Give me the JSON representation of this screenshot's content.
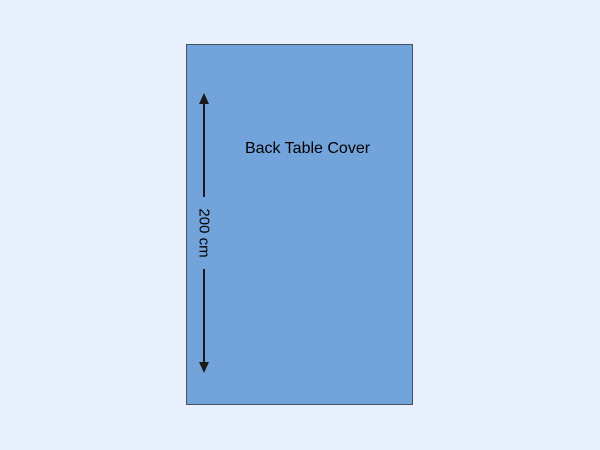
{
  "diagram": {
    "title": "Back Table Cover",
    "dimension_label": "200 cm"
  },
  "colors": {
    "page_background": "#e8effd",
    "cover_fill": "#72a3da",
    "cover_border": "#46505e",
    "arrow_and_text": "#1a1a1a"
  }
}
